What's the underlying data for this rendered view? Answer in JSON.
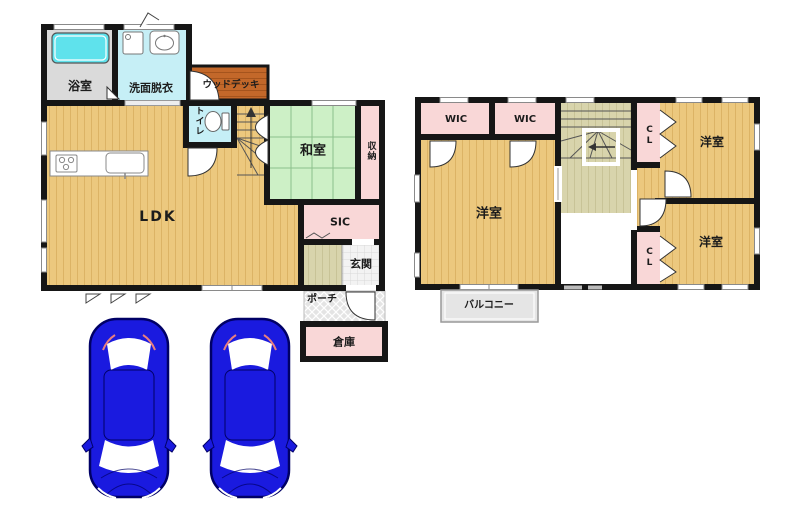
{
  "floor1": {
    "bath": "浴室",
    "washroom": "洗面脱衣",
    "wood_deck": "ウッドデッキ",
    "toilet": "トイレ",
    "japanese_room": "和室",
    "closet": "収納",
    "ldk": "LDK",
    "sic": "SIC",
    "entrance": "玄関",
    "porch": "ポーチ",
    "storage": "倉庫"
  },
  "floor2": {
    "wic1": "WIC",
    "wic2": "WIC",
    "cl_top": "CL",
    "cl_bottom": "CL",
    "bedroom_left": "洋室",
    "bedroom_right_top": "洋室",
    "bedroom_right_bottom": "洋室",
    "balcony": "バルコニー"
  },
  "colors": {
    "wall": "#161616",
    "tan": "#ECC87E",
    "tanline": "#DCB365",
    "tatami": "#CDF0C6",
    "tatamiline": "#8CC08C",
    "pink": "#F9D7D7",
    "cyan": "#C6EFF6",
    "tub": "#5FE2EC",
    "bathfloor": "#DADADA",
    "deck": "#C3682A",
    "deckline": "#A5541D",
    "khaki": "#D8D4AC",
    "khakiline": "#C8C397",
    "porch": "#E4E4E4",
    "checker": "#F3F3F3",
    "checkerline": "#D8D8D8",
    "balcony": "#E5E5E5",
    "windowframe": "#8A8A8A",
    "carbody": "#1A1ADF",
    "caroutline": "#000066",
    "text": "#1c1c1c"
  }
}
